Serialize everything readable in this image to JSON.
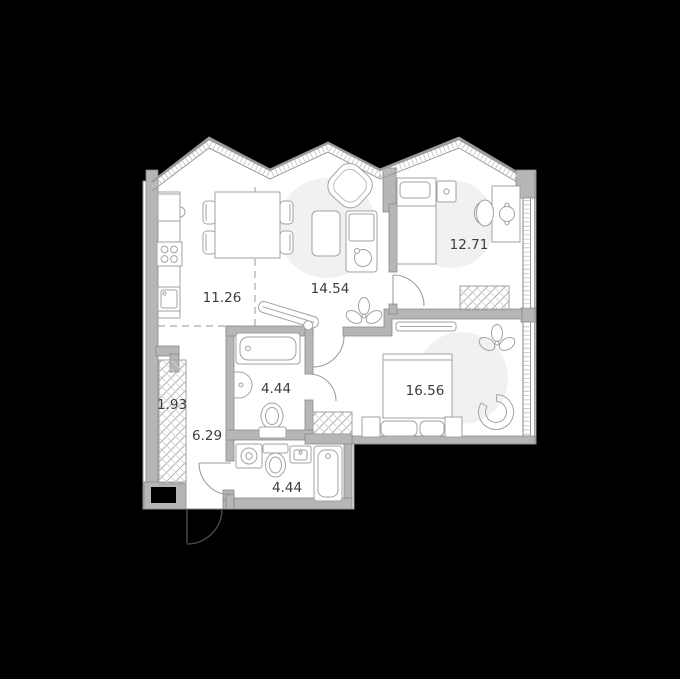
{
  "plan": {
    "type": "apartment-floor-plan",
    "rooms": {
      "kitchen_dining": {
        "area": "11.26"
      },
      "living": {
        "area": "14.54"
      },
      "bedroom": {
        "area": "12.71"
      },
      "master_bedroom": {
        "area": "16.56"
      },
      "bathroom": {
        "area": "4.44"
      },
      "hallway": {
        "area": "6.29"
      },
      "closet": {
        "area": "1.93"
      },
      "wc": {
        "area": "4.44"
      }
    },
    "icons": [
      "fridge-icon",
      "stove-icon",
      "kitchen-sink-icon",
      "dining-table",
      "chair-icon",
      "armchair-icon",
      "coffee-table",
      "sofa-icon",
      "plant-icon",
      "ironing-board-icon",
      "bed-icon",
      "nightstand-icon",
      "desk-icon",
      "desk-chair-icon",
      "wardrobe-icon",
      "tv-icon",
      "double-bed-icon",
      "drawer-icon",
      "lounge-chair-icon",
      "bathtub-icon",
      "washbasin-icon",
      "toilet-icon",
      "washing-machine-icon",
      "shaft-icon",
      "entrance-door"
    ],
    "colors": {
      "background": "#000000",
      "floor": "#ffffff",
      "wall": "#b6b6b6",
      "wall_outline": "#8a8a8a",
      "window_line": "#9a9a9a",
      "furniture_line": "#a2a2a2",
      "label_text": "#3c3c3c",
      "room_shade": "#f1f1f1"
    }
  }
}
